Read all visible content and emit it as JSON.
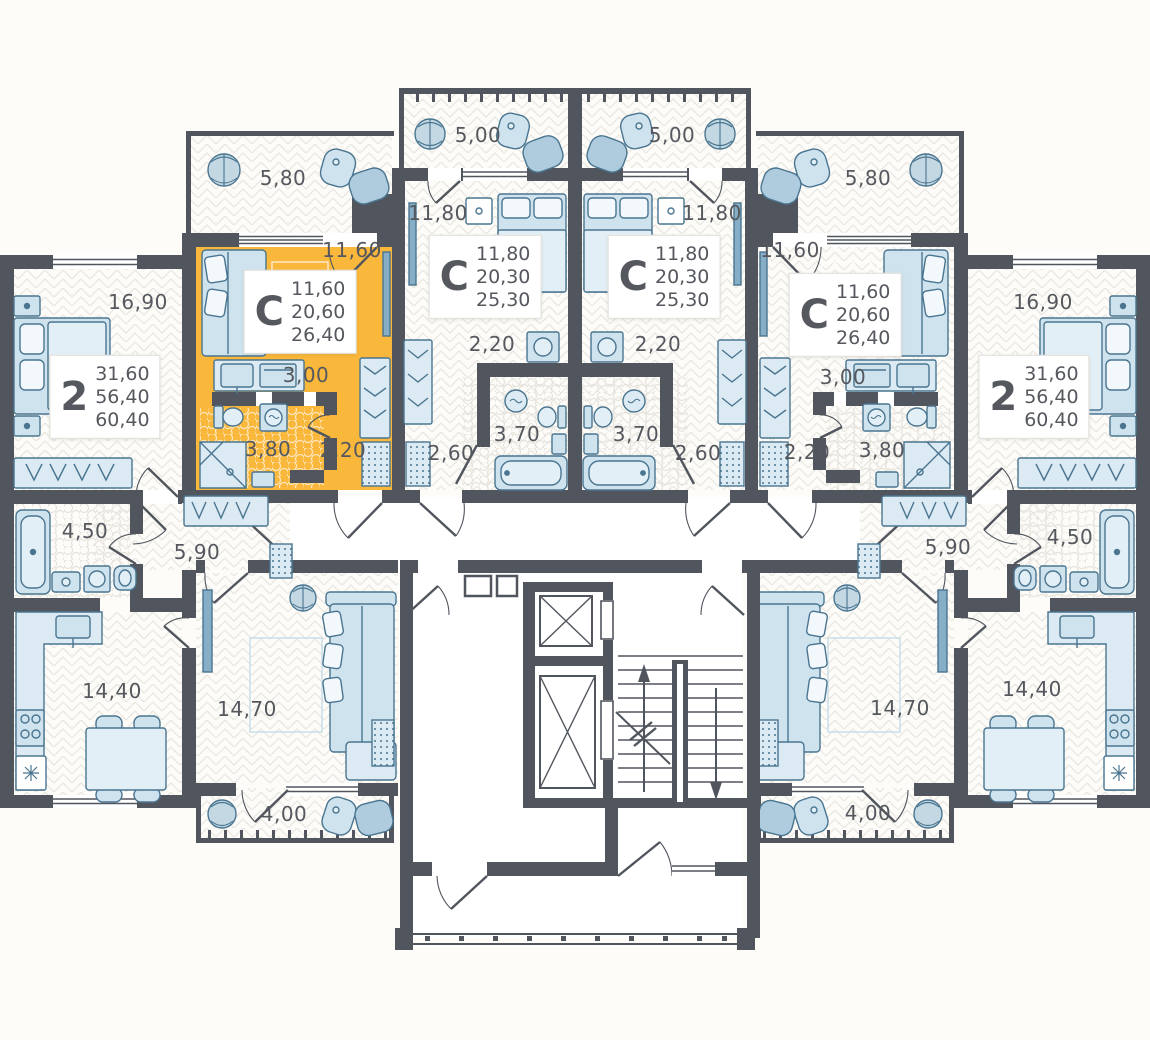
{
  "plan": {
    "colors": {
      "wall": "#51565E",
      "highlight": "#F9B73B",
      "furniture_fill": "#CFE3EF",
      "furniture_stroke": "#4A7590",
      "text": "#55585E"
    },
    "apartment_cards": [
      {
        "id": "left-2room",
        "type": "2",
        "values": [
          "31,60",
          "56,40",
          "60,40"
        ],
        "x": 105,
        "y": 397,
        "highlighted": false
      },
      {
        "id": "studio-highlighted",
        "type": "С",
        "values": [
          "11,60",
          "20,60",
          "26,40"
        ],
        "x": 300,
        "y": 312,
        "highlighted": true
      },
      {
        "id": "studio-center-left",
        "type": "С",
        "values": [
          "11,80",
          "20,30",
          "25,30"
        ],
        "x": 485,
        "y": 277,
        "highlighted": false
      },
      {
        "id": "studio-center-right",
        "type": "С",
        "values": [
          "11,80",
          "20,30",
          "25,30"
        ],
        "x": 664,
        "y": 277,
        "highlighted": false
      },
      {
        "id": "studio-right",
        "type": "С",
        "values": [
          "11,60",
          "20,60",
          "26,40"
        ],
        "x": 845,
        "y": 315,
        "highlighted": false
      },
      {
        "id": "right-2room",
        "type": "2",
        "values": [
          "31,60",
          "56,40",
          "60,40"
        ],
        "x": 1034,
        "y": 397,
        "highlighted": false
      }
    ],
    "room_labels": [
      {
        "text": "5,80",
        "x": 283,
        "y": 178
      },
      {
        "text": "5,00",
        "x": 478,
        "y": 135
      },
      {
        "text": "5,00",
        "x": 672,
        "y": 135
      },
      {
        "text": "5,80",
        "x": 868,
        "y": 178
      },
      {
        "text": "11,60",
        "x": 352,
        "y": 250
      },
      {
        "text": "11,80",
        "x": 438,
        "y": 213
      },
      {
        "text": "11,80",
        "x": 712,
        "y": 213
      },
      {
        "text": "11,60",
        "x": 790,
        "y": 250
      },
      {
        "text": "16,90",
        "x": 138,
        "y": 302
      },
      {
        "text": "16,90",
        "x": 1043,
        "y": 302
      },
      {
        "text": "3,00",
        "x": 306,
        "y": 375
      },
      {
        "text": "3,00",
        "x": 843,
        "y": 377
      },
      {
        "text": "2,20",
        "x": 492,
        "y": 344
      },
      {
        "text": "2,20",
        "x": 658,
        "y": 344
      },
      {
        "text": "2,20",
        "x": 343,
        "y": 450
      },
      {
        "text": "2,20",
        "x": 807,
        "y": 452
      },
      {
        "text": "3,80",
        "x": 268,
        "y": 449
      },
      {
        "text": "3,80",
        "x": 882,
        "y": 450
      },
      {
        "text": "3,70",
        "x": 517,
        "y": 434
      },
      {
        "text": "3,70",
        "x": 636,
        "y": 434
      },
      {
        "text": "2,60",
        "x": 451,
        "y": 453
      },
      {
        "text": "2,60",
        "x": 698,
        "y": 453
      },
      {
        "text": "4,50",
        "x": 85,
        "y": 531
      },
      {
        "text": "4,50",
        "x": 1070,
        "y": 537
      },
      {
        "text": "5,90",
        "x": 197,
        "y": 552
      },
      {
        "text": "5,90",
        "x": 948,
        "y": 547
      },
      {
        "text": "14,40",
        "x": 112,
        "y": 691
      },
      {
        "text": "14,40",
        "x": 1032,
        "y": 689
      },
      {
        "text": "14,70",
        "x": 247,
        "y": 709
      },
      {
        "text": "14,70",
        "x": 900,
        "y": 708
      },
      {
        "text": "4,00",
        "x": 284,
        "y": 814
      },
      {
        "text": "4,00",
        "x": 868,
        "y": 813
      }
    ]
  }
}
